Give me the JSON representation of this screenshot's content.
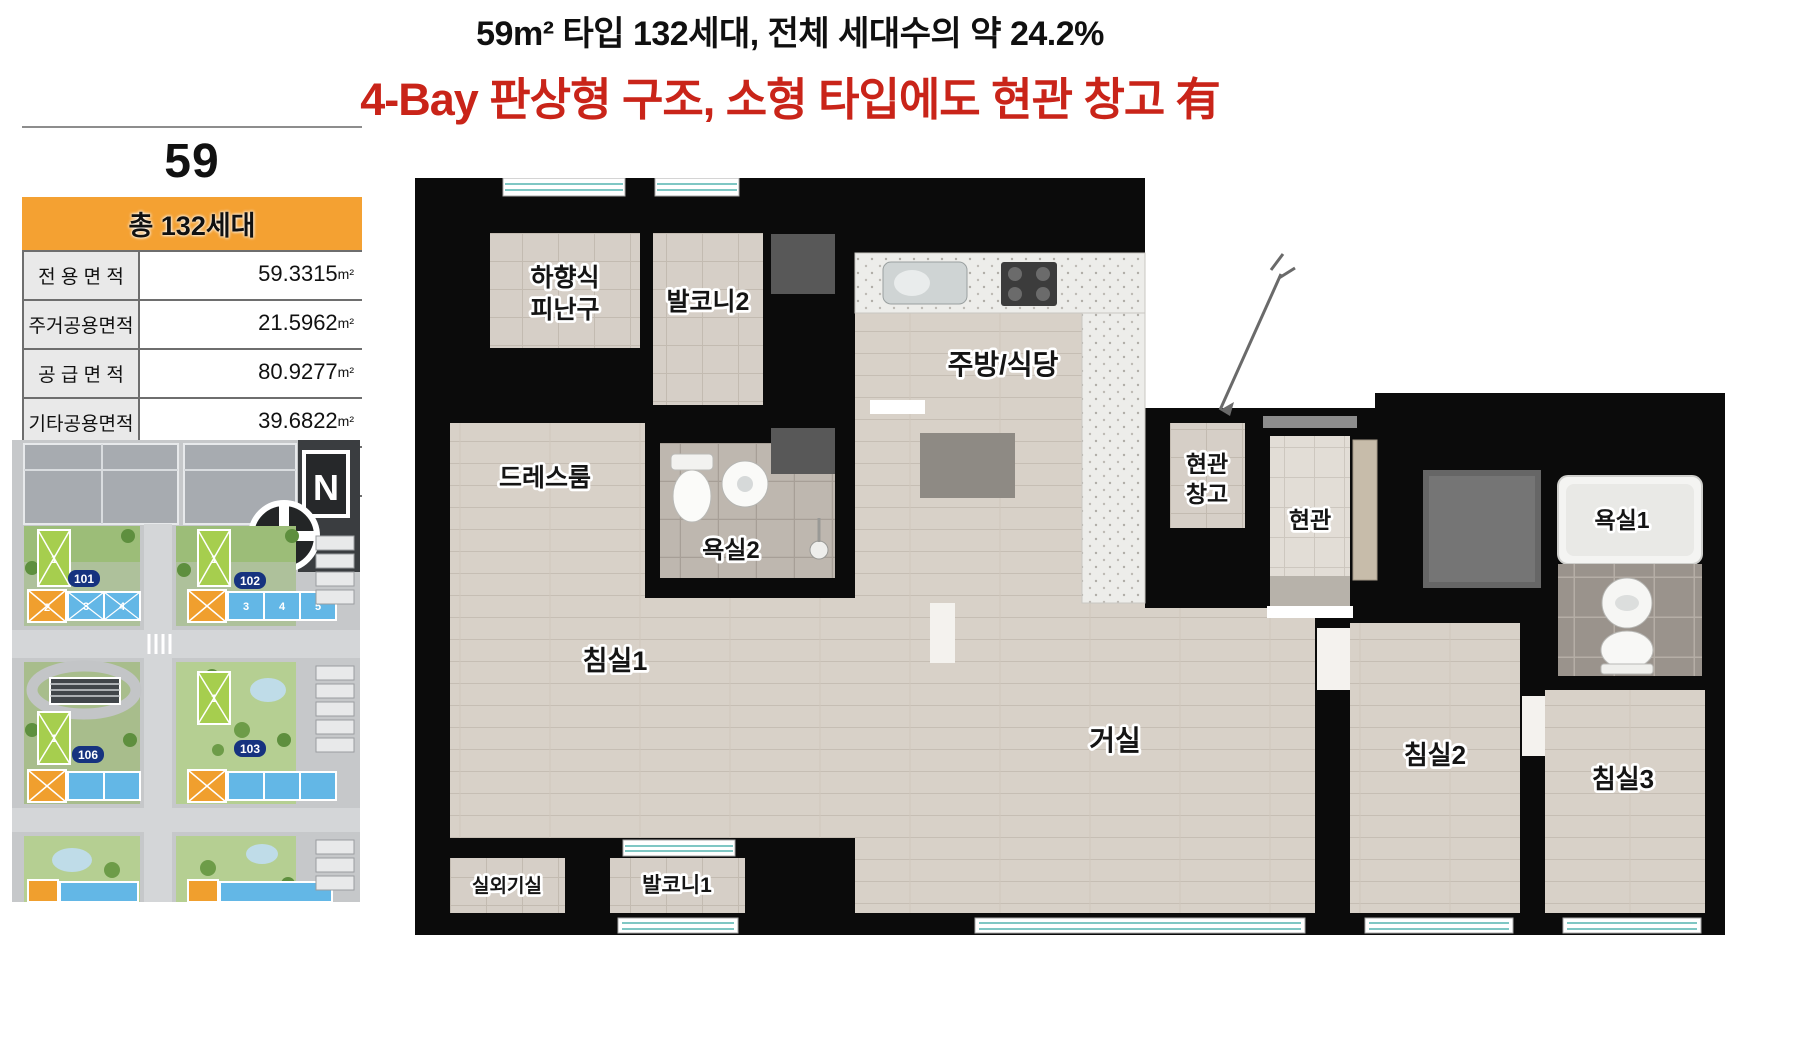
{
  "header": {
    "line1": "59m² 타입 132세대, 전체 세대수의 약 24.2%",
    "line2": "4-Bay 판상형 구조, 소형 타입에도 현관 창고 有"
  },
  "info_panel": {
    "type_number": "59",
    "total": "총 132세대",
    "rows": [
      {
        "label": "전 용 면 적",
        "value": "59.3315",
        "unit": "m²"
      },
      {
        "label": "주거공용면적",
        "value": "21.5962",
        "unit": "m²"
      },
      {
        "label": "공 급 면 적",
        "value": "80.9277",
        "unit": "m²"
      },
      {
        "label": "기타공용면적",
        "value": "39.6822",
        "unit": "m²"
      },
      {
        "label": "계 약 면 적",
        "value": "120.6099",
        "unit": "m²"
      }
    ]
  },
  "site_map": {
    "compass": "N",
    "blocks": [
      {
        "id": "101"
      },
      {
        "id": "102"
      },
      {
        "id": "106"
      },
      {
        "id": "103"
      }
    ],
    "unit_numbers": [
      "1",
      "2",
      "3",
      "4",
      "5"
    ]
  },
  "floor_plan": {
    "rooms": {
      "escape_1": "하향식",
      "escape_2": "피난구",
      "balcony2": "발코니2",
      "kitchen": "주방/식당",
      "dressroom": "드레스룸",
      "bath2": "욕실2",
      "storage_1": "현관",
      "storage_2": "창고",
      "entry": "현관",
      "bath1": "욕실1",
      "bedroom1": "침실1",
      "living": "거실",
      "bedroom2": "침실2",
      "bedroom3": "침실3",
      "outdoor_unit": "실외기실",
      "balcony1": "발코니1"
    }
  },
  "colors": {
    "accent_orange": "#f4a132",
    "title_red": "#c92419",
    "wall_black": "#0b0b0b"
  }
}
